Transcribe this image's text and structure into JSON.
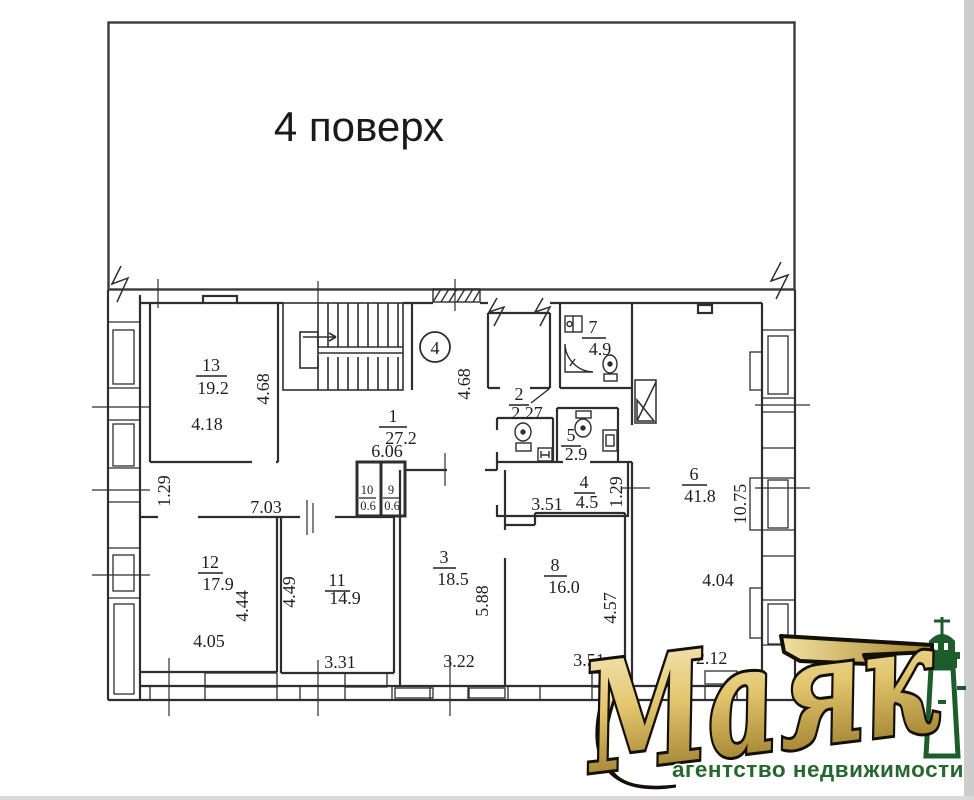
{
  "title": "4 поверх",
  "floor_circle": "4",
  "rooms": [
    {
      "number": "13",
      "area": "19.2"
    },
    {
      "number": "1",
      "area": "27.2"
    },
    {
      "number": "2",
      "area": "2.27"
    },
    {
      "number": "7",
      "area": "4.9"
    },
    {
      "number": "5",
      "area": "2.9"
    },
    {
      "number": "10",
      "area": "0.6"
    },
    {
      "number": "9",
      "area": "0.6"
    },
    {
      "number": "4",
      "area": "4.5"
    },
    {
      "number": "6",
      "area": "41.8"
    },
    {
      "number": "3",
      "area": "18.5"
    },
    {
      "number": "8",
      "area": "16.0"
    },
    {
      "number": "12",
      "area": "17.9"
    },
    {
      "number": "11",
      "area": "14.9"
    }
  ],
  "dimensions": [
    "4.18",
    "4.68",
    "4.68",
    "6.06",
    "7.03",
    "1.29",
    "3.51",
    "1.29",
    "10.75",
    "4.04",
    "4.44",
    "4.05",
    "4.49",
    "3.31",
    "5.88",
    "3.22",
    "4.57",
    "3.51"
  ],
  "ceiling_height": "H=2.12",
  "logo": {
    "name": "Маяк",
    "tagline": "агентство недвижимости"
  },
  "colors": {
    "line": "#2e2e2e",
    "gold": "#c9a23f",
    "gold_light": "#f3e5b2",
    "gold_dark": "#8a6a1c",
    "green": "#1d5c2b"
  }
}
